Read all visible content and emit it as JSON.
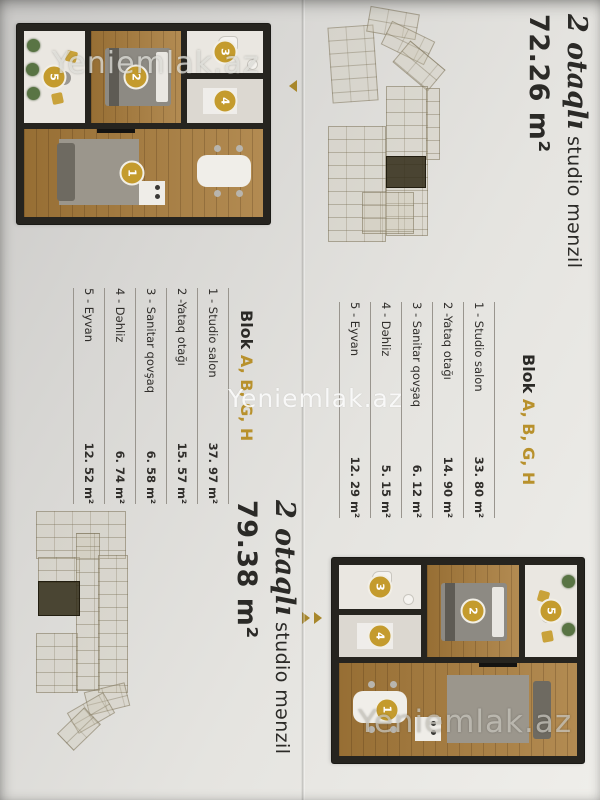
{
  "watermark": "Yeniemlak.az",
  "badges": [
    "1",
    "2",
    "3",
    "4",
    "5"
  ],
  "colors": {
    "accent_gold": "#b8912c",
    "badge_gold": "#c49b2d",
    "wall_dark": "#26241f",
    "wood_floor": "#a87b3a"
  },
  "listings": [
    {
      "title_script": "2 otaqlı",
      "title_rest": " studio mənzil",
      "area_total": "72.26 m²",
      "block_word": "Blok ",
      "block_letters": "A, B, G, H",
      "rooms": [
        {
          "name": "1 - Studio salon",
          "area": "33. 80 m²"
        },
        {
          "name": "2 -Yataq otağı",
          "area": "14. 90 m²"
        },
        {
          "name": "3 - Sanitar qovşaq",
          "area": "6. 12 m²"
        },
        {
          "name": "4 - Dəhliz",
          "area": "5. 15 m²"
        },
        {
          "name": "5 - Eyvan",
          "area": "12. 29 m²"
        }
      ]
    },
    {
      "title_script": "2 otaqlı",
      "title_rest": " studio mənzil",
      "area_total": "79.38 m²",
      "block_word": "Blok ",
      "block_letters": "A, B, G, H",
      "rooms": [
        {
          "name": "1 - Studio salon",
          "area": "37. 97 m²"
        },
        {
          "name": "2 -Yataq otağı",
          "area": "15. 57 m²"
        },
        {
          "name": "3 - Sanitar qovşaq",
          "area": "6. 58 m²"
        },
        {
          "name": "4 - Dəhliz",
          "area": "6. 74 m²"
        },
        {
          "name": "5 - Eyvan",
          "area": "12. 52 m²"
        }
      ]
    }
  ]
}
